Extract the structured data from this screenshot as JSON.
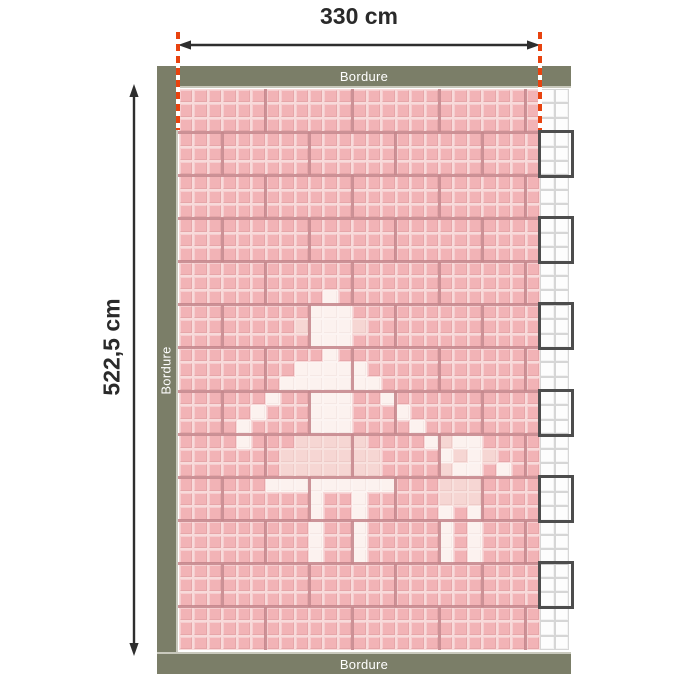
{
  "dimension_labels": {
    "width": "330 cm",
    "height": "522,5 cm"
  },
  "border": {
    "label": "Bordure"
  },
  "palette": {
    "tile_pink": "#f2b3b6",
    "tile_pink_grout": "#f8dada",
    "figure_white": "#fcf2ef",
    "figure_white_grout": "#fcf4f2",
    "figure_pale": "#f6d6d3",
    "figure_pale_grout": "#f8e1de",
    "empty_tile": "#fdfdfd",
    "empty_tile_grout": "#d6d6d6",
    "brick_joint": "#c5868c",
    "empty_zone_joint": "#c9c9c9",
    "overhang_outline": "#4d4d4d",
    "strip": "#7b7e68",
    "strip_edge": "#c9c9bd",
    "strip_text": "#ffffff",
    "guide_red": "#e8430f",
    "arrow": "#2e2e2e",
    "label": "#2a2a2a"
  },
  "mosaic": {
    "cols": 27,
    "rows": 39,
    "pink_cols": 25,
    "brick": {
      "tile_cols": 6,
      "tile_rows": 3,
      "row_offsets": [
        0,
        3
      ],
      "outlined_overhang_rows": [
        1,
        3,
        5,
        7,
        9,
        11
      ]
    },
    "legend": {
      ".": "pink-tile",
      "W": "figure-white-tile",
      "w": "figure-pale-tile",
      "o": "uncut-white-tile"
    },
    "grid": [
      ".........................oo",
      ".........................oo",
      ".........................oo",
      ".........................oo",
      ".........................oo",
      ".........................oo",
      ".........................oo",
      ".........................oo",
      ".........................oo",
      ".........................oo",
      ".........................oo",
      ".........................oo",
      ".........................oo",
      ".........................oo",
      "..........W..............oo",
      ".........WWW.............oo",
      "........wWWWw............oo",
      ".........WWW.............oo",
      "..........W..............oo",
      "........WWWWW............oo",
      ".......WWWWWWW...........oo",
      "......W..WWW..W..........oo",
      ".....W...WWW...W.........oo",
      "....W....WWW....W........oo",
      "....W...wwwww....WwWW....oo",
      ".......wwwwwww....WwWw...oo",
      ".......wwwwwww....wWW.W..oo",
      "......WWWWWWWWW...www....oo",
      ".........W..W.....www....oo",
      ".........W..W.....W.W....oo",
      ".........W..W.....W.W....oo",
      ".........W..W.....W.W....oo",
      ".........W..W.....W.W....oo",
      ".........................oo",
      ".........................oo",
      ".........................oo",
      ".........................oo",
      ".........................oo",
      ".........................oo"
    ]
  }
}
